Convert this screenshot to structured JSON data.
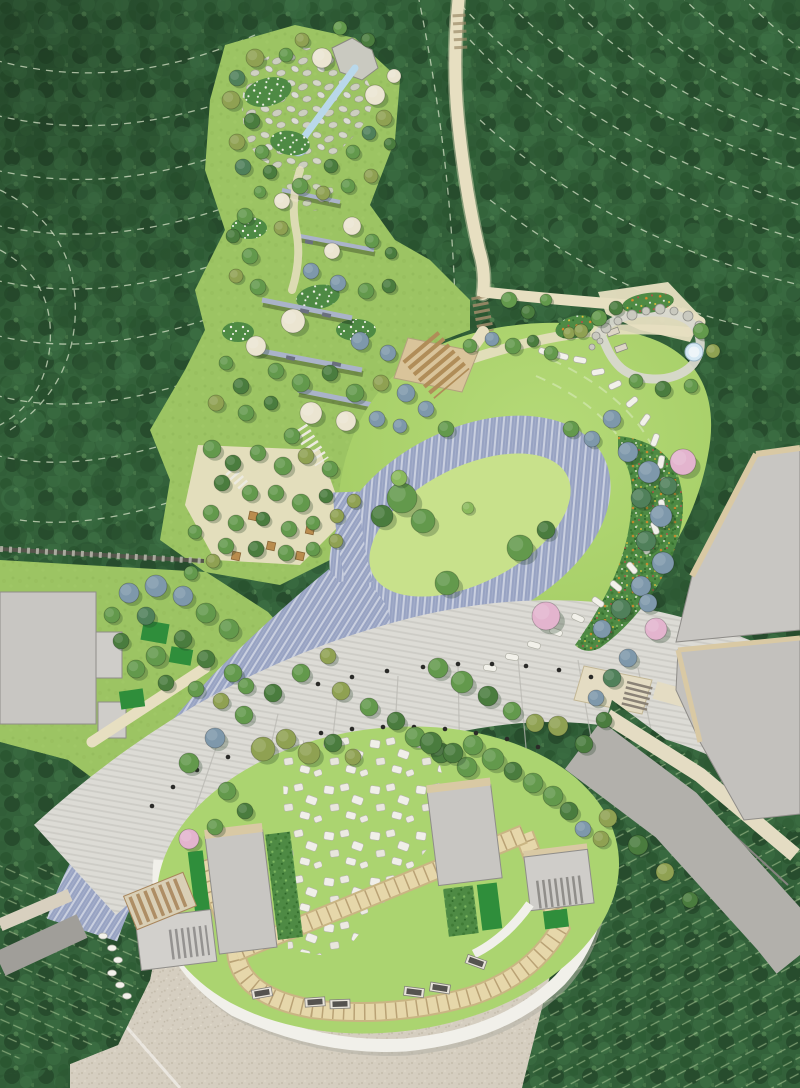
{
  "scene": {
    "width": 800,
    "height": 1088,
    "label": "Landscape architecture master plan rendering, aerial plan view"
  },
  "palette": {
    "forest": "#33613a",
    "forestDark": "#274f2e",
    "forestLight": "#44744a",
    "contour": "#d9e5cb",
    "park": "#9cc463",
    "lawn": "#a9d16c",
    "lawnBright": "#c8e18b",
    "lawnPlaza": "#abd470",
    "pave": "#98a3c3",
    "paveStripe": "#ccd2e2",
    "water": "#b9d8ea",
    "pool": "#d6e9f4",
    "prom": "#dcdbd5",
    "promSeam": "#b9b8b2",
    "trail": "#e7dfc1",
    "gravel": "#d5cec0",
    "gravelDot": "#c4bcab",
    "whiteRing": "#f1f0ea",
    "ringShadow": "#b3b0a6",
    "tilePath": "#e6d7aa",
    "tileEdge": "#c9b583",
    "tileTick": "#b9a275",
    "asphalt": "#b2b0ab",
    "asphaltEdge": "#85837f",
    "roadLeft": "#a09e99",
    "sidewalk": "#e4dcc3",
    "roof": "#c8c6c2",
    "roofEdge": "#d9c9a4",
    "roofLine": "#8f8d89",
    "hedge": "#2f8e3b",
    "shrub": "#4e8a44",
    "stone": "#d8d8cf",
    "stoneEdge": "#a6a69b",
    "wall": "#aab3c9",
    "wallDark": "#56564c",
    "bench": "#55534f",
    "benchFrame": "#e8e4da",
    "bollard": "#2a2a28",
    "woodStep": "#b08d58",
    "woodBase": "#d9c49a",
    "pergola": "#d9cfb6",
    "pergolaLine": "#a8865c",
    "treeGreen": "#63994c",
    "treeDark": "#4a7c3e",
    "treeOlive": "#8fa152",
    "treeBlue": "#7e98ab",
    "treeTeal": "#50805a",
    "treeCream": "#ebe5d1",
    "treePink": "#e3b4ce",
    "treeLight": "#8ab95c",
    "flowerOrange": "#e0892a",
    "flowerRed": "#c24848",
    "flowerYellow": "#e8c43a",
    "flowerWhite": "#f2f2ea",
    "rockFill": "#c9c9bf",
    "rockEdge": "#90908a",
    "stepLine": "#9b8a68"
  },
  "features": [
    "hillside-forest",
    "contour-lines",
    "stream-and-rock-garden",
    "terraced-gardens",
    "picnic-grove",
    "great-lawn",
    "oval-paved-ring",
    "stepping-stone-path",
    "flower-borders",
    "stone-court-with-pool",
    "forest-trail",
    "paved-road",
    "tree-lined-promenade",
    "memorial-stone-plaza",
    "pavilions",
    "benches",
    "service-buildings",
    "access-roads",
    "orchard-rows",
    "gravel-forecourt"
  ],
  "trees": [
    [
      255,
      58,
      9,
      "o"
    ],
    [
      237,
      78,
      8,
      "t"
    ],
    [
      231,
      100,
      9,
      "o"
    ],
    [
      252,
      121,
      8,
      "d"
    ],
    [
      237,
      142,
      8,
      "o"
    ],
    [
      262,
      152,
      7,
      "g"
    ],
    [
      243,
      167,
      8,
      "t"
    ],
    [
      270,
      172,
      7,
      "d"
    ],
    [
      286,
      55,
      7,
      "g"
    ],
    [
      302,
      40,
      7,
      "o"
    ],
    [
      340,
      28,
      7,
      "g"
    ],
    [
      368,
      40,
      7,
      "d"
    ],
    [
      322,
      58,
      10,
      "c"
    ],
    [
      375,
      95,
      10,
      "c"
    ],
    [
      394,
      76,
      7,
      "c"
    ],
    [
      384,
      118,
      8,
      "o"
    ],
    [
      369,
      133,
      7,
      "t"
    ],
    [
      390,
      144,
      6,
      "d"
    ],
    [
      353,
      152,
      7,
      "g"
    ],
    [
      331,
      166,
      7,
      "d"
    ],
    [
      300,
      186,
      8,
      "g"
    ],
    [
      323,
      193,
      7,
      "o"
    ],
    [
      348,
      186,
      7,
      "g"
    ],
    [
      371,
      176,
      7,
      "o"
    ],
    [
      282,
      201,
      8,
      "c"
    ],
    [
      260,
      192,
      6,
      "g"
    ],
    [
      245,
      216,
      8,
      "g"
    ],
    [
      233,
      236,
      7,
      "d"
    ],
    [
      250,
      256,
      8,
      "g"
    ],
    [
      236,
      276,
      7,
      "o"
    ],
    [
      258,
      287,
      8,
      "g"
    ],
    [
      281,
      228,
      7,
      "o"
    ],
    [
      352,
      226,
      9,
      "c"
    ],
    [
      332,
      251,
      8,
      "c"
    ],
    [
      372,
      241,
      7,
      "g"
    ],
    [
      391,
      253,
      6,
      "d"
    ],
    [
      311,
      271,
      8,
      "b"
    ],
    [
      338,
      283,
      8,
      "b"
    ],
    [
      366,
      291,
      8,
      "g"
    ],
    [
      389,
      286,
      7,
      "d"
    ],
    [
      293,
      321,
      12,
      "c"
    ],
    [
      256,
      346,
      10,
      "c"
    ],
    [
      360,
      341,
      9,
      "b"
    ],
    [
      388,
      353,
      8,
      "b"
    ],
    [
      276,
      371,
      8,
      "g"
    ],
    [
      301,
      383,
      9,
      "g"
    ],
    [
      330,
      373,
      8,
      "d"
    ],
    [
      355,
      393,
      9,
      "g"
    ],
    [
      381,
      383,
      8,
      "o"
    ],
    [
      241,
      386,
      8,
      "d"
    ],
    [
      226,
      363,
      7,
      "g"
    ],
    [
      216,
      403,
      8,
      "o"
    ],
    [
      246,
      413,
      8,
      "g"
    ],
    [
      271,
      403,
      7,
      "d"
    ],
    [
      311,
      413,
      11,
      "c"
    ],
    [
      346,
      421,
      10,
      "c"
    ],
    [
      377,
      419,
      8,
      "b"
    ],
    [
      400,
      426,
      7,
      "b"
    ],
    [
      292,
      436,
      8,
      "g"
    ],
    [
      212,
      449,
      9,
      "g"
    ],
    [
      233,
      463,
      8,
      "d"
    ],
    [
      258,
      453,
      8,
      "g"
    ],
    [
      283,
      466,
      9,
      "g"
    ],
    [
      306,
      456,
      8,
      "o"
    ],
    [
      330,
      469,
      8,
      "g"
    ],
    [
      222,
      483,
      8,
      "d"
    ],
    [
      250,
      493,
      8,
      "g"
    ],
    [
      276,
      493,
      8,
      "g"
    ],
    [
      301,
      503,
      9,
      "g"
    ],
    [
      326,
      496,
      7,
      "d"
    ],
    [
      211,
      513,
      8,
      "g"
    ],
    [
      236,
      523,
      8,
      "g"
    ],
    [
      263,
      519,
      7,
      "d"
    ],
    [
      289,
      529,
      8,
      "g"
    ],
    [
      313,
      523,
      7,
      "g"
    ],
    [
      337,
      516,
      7,
      "o"
    ],
    [
      354,
      501,
      7,
      "o"
    ],
    [
      226,
      546,
      8,
      "g"
    ],
    [
      256,
      549,
      8,
      "d"
    ],
    [
      286,
      553,
      8,
      "g"
    ],
    [
      313,
      549,
      7,
      "g"
    ],
    [
      336,
      541,
      7,
      "o"
    ],
    [
      195,
      532,
      7,
      "g"
    ],
    [
      406,
      393,
      9,
      "b"
    ],
    [
      426,
      409,
      8,
      "b"
    ],
    [
      446,
      429,
      8,
      "g"
    ],
    [
      470,
      346,
      7,
      "g"
    ],
    [
      492,
      339,
      7,
      "b"
    ],
    [
      513,
      346,
      8,
      "g"
    ],
    [
      533,
      341,
      6,
      "d"
    ],
    [
      551,
      353,
      7,
      "g"
    ],
    [
      569,
      333,
      6,
      "o"
    ],
    [
      509,
      300,
      8,
      "g"
    ],
    [
      528,
      312,
      7,
      "d"
    ],
    [
      546,
      300,
      6,
      "g"
    ],
    [
      402,
      498,
      15,
      "g"
    ],
    [
      382,
      516,
      11,
      "d"
    ],
    [
      423,
      521,
      12,
      "g"
    ],
    [
      399,
      478,
      8,
      "l"
    ],
    [
      447,
      583,
      12,
      "g"
    ],
    [
      520,
      548,
      13,
      "g"
    ],
    [
      546,
      530,
      9,
      "d"
    ],
    [
      468,
      508,
      6,
      "l"
    ],
    [
      599,
      318,
      8,
      "g"
    ],
    [
      616,
      308,
      7,
      "d"
    ],
    [
      701,
      331,
      8,
      "g"
    ],
    [
      713,
      351,
      7,
      "o"
    ],
    [
      691,
      386,
      7,
      "g"
    ],
    [
      663,
      389,
      8,
      "d"
    ],
    [
      636,
      381,
      7,
      "g"
    ],
    [
      581,
      331,
      7,
      "o"
    ],
    [
      612,
      419,
      9,
      "b"
    ],
    [
      592,
      439,
      8,
      "b"
    ],
    [
      571,
      429,
      8,
      "g"
    ],
    [
      628,
      452,
      10,
      "b"
    ],
    [
      649,
      472,
      11,
      "b"
    ],
    [
      641,
      498,
      10,
      "t"
    ],
    [
      661,
      516,
      11,
      "b"
    ],
    [
      646,
      541,
      10,
      "t"
    ],
    [
      663,
      563,
      11,
      "b"
    ],
    [
      641,
      586,
      10,
      "b"
    ],
    [
      621,
      609,
      10,
      "t"
    ],
    [
      602,
      629,
      9,
      "b"
    ],
    [
      668,
      486,
      9,
      "t"
    ],
    [
      648,
      603,
      9,
      "b"
    ],
    [
      683,
      462,
      13,
      "p"
    ],
    [
      656,
      629,
      11,
      "p"
    ],
    [
      546,
      616,
      14,
      "p"
    ],
    [
      628,
      658,
      9,
      "b"
    ],
    [
      612,
      678,
      9,
      "t"
    ],
    [
      596,
      698,
      8,
      "b"
    ],
    [
      604,
      720,
      8,
      "d"
    ],
    [
      438,
      668,
      10,
      "g"
    ],
    [
      462,
      682,
      11,
      "g"
    ],
    [
      488,
      696,
      10,
      "d"
    ],
    [
      512,
      711,
      9,
      "g"
    ],
    [
      535,
      723,
      9,
      "o"
    ],
    [
      415,
      737,
      10,
      "g"
    ],
    [
      441,
      753,
      10,
      "d"
    ],
    [
      467,
      767,
      10,
      "g"
    ],
    [
      341,
      691,
      9,
      "o"
    ],
    [
      369,
      707,
      9,
      "g"
    ],
    [
      396,
      721,
      9,
      "d"
    ],
    [
      189,
      763,
      10,
      "g"
    ],
    [
      215,
      738,
      10,
      "b"
    ],
    [
      244,
      715,
      9,
      "g"
    ],
    [
      273,
      693,
      9,
      "d"
    ],
    [
      301,
      673,
      9,
      "g"
    ],
    [
      328,
      656,
      8,
      "o"
    ],
    [
      263,
      749,
      12,
      "o"
    ],
    [
      286,
      739,
      10,
      "o"
    ],
    [
      309,
      753,
      11,
      "o"
    ],
    [
      333,
      743,
      9,
      "d"
    ],
    [
      353,
      757,
      8,
      "o"
    ],
    [
      431,
      743,
      11,
      "d"
    ],
    [
      453,
      753,
      10,
      "d"
    ],
    [
      473,
      745,
      10,
      "g"
    ],
    [
      493,
      759,
      11,
      "g"
    ],
    [
      513,
      771,
      9,
      "d"
    ],
    [
      533,
      783,
      10,
      "g"
    ],
    [
      553,
      796,
      10,
      "g"
    ],
    [
      569,
      811,
      9,
      "d"
    ],
    [
      227,
      791,
      9,
      "g"
    ],
    [
      245,
      811,
      8,
      "d"
    ],
    [
      215,
      827,
      8,
      "g"
    ],
    [
      189,
      839,
      10,
      "p"
    ],
    [
      583,
      829,
      8,
      "b"
    ],
    [
      601,
      839,
      8,
      "o"
    ],
    [
      558,
      726,
      10,
      "o"
    ],
    [
      584,
      744,
      9,
      "d"
    ],
    [
      608,
      818,
      9,
      "o"
    ],
    [
      638,
      845,
      10,
      "d"
    ],
    [
      665,
      872,
      9,
      "o"
    ],
    [
      690,
      900,
      8,
      "d"
    ],
    [
      129,
      593,
      10,
      "b"
    ],
    [
      156,
      586,
      11,
      "b"
    ],
    [
      183,
      596,
      10,
      "b"
    ],
    [
      146,
      616,
      9,
      "t"
    ],
    [
      206,
      613,
      10,
      "g"
    ],
    [
      229,
      629,
      10,
      "g"
    ],
    [
      183,
      639,
      9,
      "d"
    ],
    [
      156,
      656,
      10,
      "g"
    ],
    [
      206,
      659,
      9,
      "d"
    ],
    [
      233,
      673,
      9,
      "g"
    ],
    [
      121,
      641,
      8,
      "d"
    ],
    [
      136,
      669,
      9,
      "g"
    ],
    [
      166,
      683,
      8,
      "d"
    ],
    [
      196,
      689,
      8,
      "g"
    ],
    [
      221,
      701,
      8,
      "o"
    ],
    [
      246,
      686,
      8,
      "g"
    ],
    [
      112,
      615,
      8,
      "g"
    ],
    [
      213,
      561,
      7,
      "o"
    ],
    [
      191,
      573,
      7,
      "g"
    ]
  ],
  "bollards": [
    [
      318,
      684
    ],
    [
      352,
      677
    ],
    [
      387,
      671
    ],
    [
      423,
      667
    ],
    [
      458,
      664
    ],
    [
      492,
      664
    ],
    [
      526,
      666
    ],
    [
      559,
      670
    ],
    [
      591,
      677
    ],
    [
      152,
      806
    ],
    [
      173,
      787
    ],
    [
      197,
      770
    ],
    [
      228,
      757
    ],
    [
      259,
      747
    ],
    [
      290,
      739
    ],
    [
      321,
      733
    ],
    [
      352,
      729
    ],
    [
      383,
      727
    ],
    [
      414,
      727
    ],
    [
      445,
      729
    ],
    [
      476,
      733
    ],
    [
      507,
      739
    ],
    [
      538,
      747
    ]
  ],
  "benches": [
    [
      262,
      993,
      -10
    ],
    [
      315,
      1002,
      -4
    ],
    [
      340,
      1004,
      -2
    ],
    [
      414,
      992,
      7
    ],
    [
      440,
      988,
      9
    ],
    [
      476,
      962,
      20
    ]
  ],
  "stepping_stones": [
    [
      545,
      352,
      20
    ],
    [
      562,
      356,
      15
    ],
    [
      580,
      360,
      10
    ],
    [
      598,
      372,
      -10
    ],
    [
      615,
      385,
      -25
    ],
    [
      632,
      402,
      -40
    ],
    [
      645,
      420,
      -55
    ],
    [
      655,
      440,
      -70
    ],
    [
      661,
      462,
      -80
    ],
    [
      664,
      484,
      -88
    ],
    [
      662,
      506,
      80
    ],
    [
      655,
      528,
      70
    ],
    [
      645,
      548,
      60
    ],
    [
      632,
      568,
      50
    ],
    [
      616,
      586,
      40
    ],
    [
      598,
      602,
      35
    ],
    [
      578,
      618,
      25
    ],
    [
      556,
      632,
      20
    ],
    [
      534,
      645,
      15
    ],
    [
      512,
      657,
      10
    ],
    [
      490,
      668,
      8
    ]
  ],
  "stone_chain": [
    [
      103,
      936
    ],
    [
      112,
      948
    ],
    [
      118,
      960
    ],
    [
      112,
      973
    ],
    [
      120,
      985
    ],
    [
      127,
      996
    ]
  ],
  "picnic_tables": [
    [
      253,
      516
    ],
    [
      271,
      546
    ],
    [
      300,
      556
    ],
    [
      236,
      556
    ],
    [
      310,
      530
    ]
  ],
  "boulders": [
    [
      596,
      336,
      4
    ],
    [
      606,
      328,
      5
    ],
    [
      618,
      321,
      4
    ],
    [
      632,
      315,
      5
    ],
    [
      646,
      311,
      4
    ],
    [
      660,
      309,
      5
    ],
    [
      674,
      311,
      4
    ],
    [
      688,
      316,
      5
    ],
    [
      699,
      325,
      4
    ],
    [
      600,
      341,
      3
    ],
    [
      592,
      347,
      3
    ]
  ]
}
